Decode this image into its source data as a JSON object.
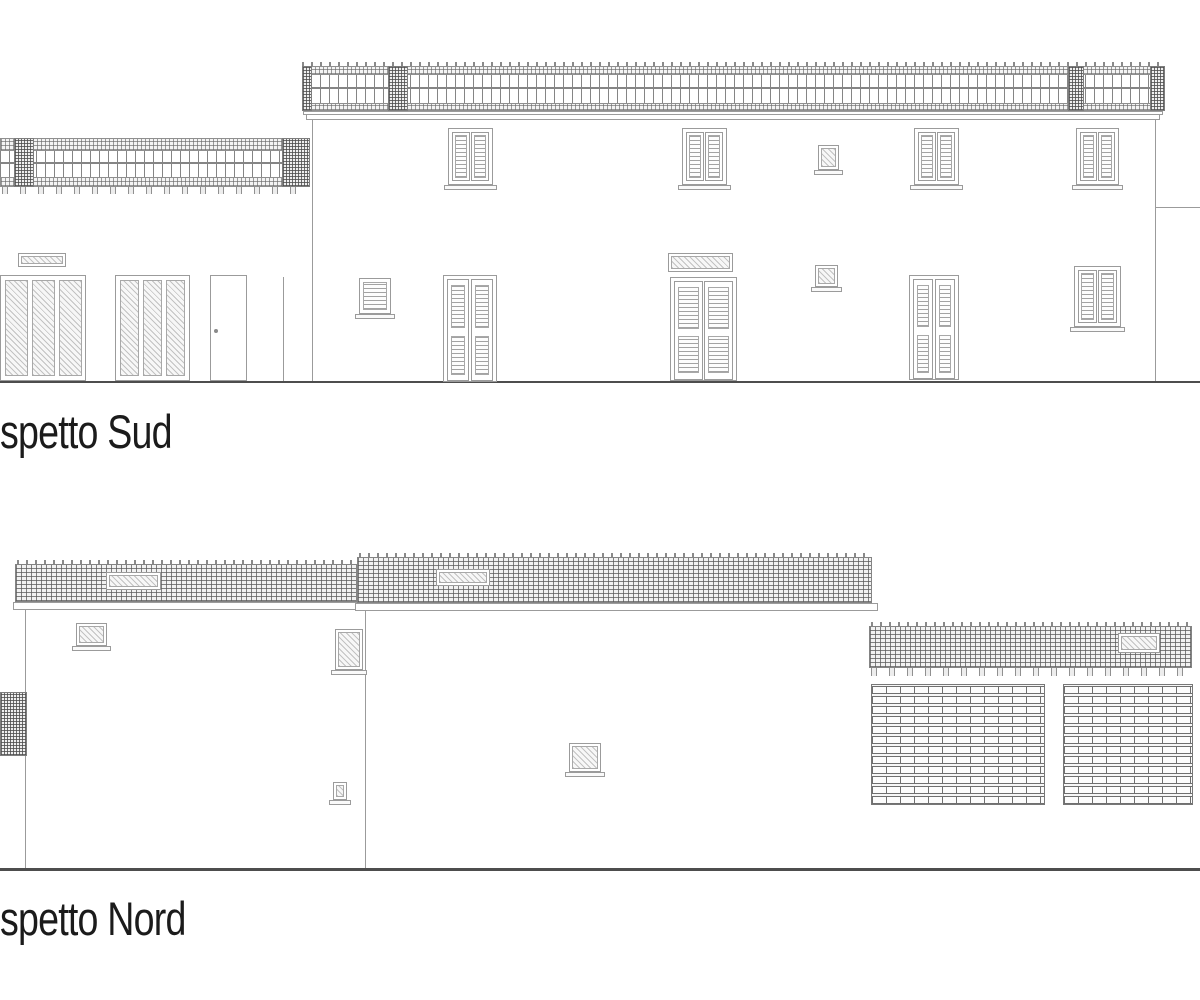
{
  "drawing": {
    "type": "architectural-elevation-drawing",
    "colors": {
      "line": "#9b9b9b",
      "dark": "#4d4d4d",
      "text": "#1b1b1b",
      "bg": "#ffffff"
    }
  },
  "elevations": [
    {
      "id": "sud",
      "label": "spetto Sud",
      "elements": [
        {
          "type": "hline",
          "name": "ground-line-sud",
          "cls": "dark",
          "rect": [
            0,
            381,
            1200,
            2
          ]
        },
        {
          "type": "band",
          "name": "wing-pergola-top-band",
          "rect": [
            0,
            138,
            310,
            13
          ]
        },
        {
          "type": "posts",
          "name": "wing-pergola-posts",
          "rect": [
            0,
            151,
            310,
            26
          ]
        },
        {
          "type": "midrail",
          "name": "wing-pergola-midrail",
          "rect": [
            0,
            162,
            310,
            2
          ]
        },
        {
          "type": "band",
          "name": "wing-pergola-bottom-band",
          "rect": [
            0,
            177,
            310,
            10
          ]
        },
        {
          "type": "feet",
          "name": "wing-pergola-feet",
          "rect": [
            2,
            187,
            306,
            7
          ]
        },
        {
          "type": "pillar",
          "name": "wing-pergola-pillar-left",
          "rect": [
            14,
            138,
            20,
            49
          ]
        },
        {
          "type": "pillar",
          "name": "wing-pergola-pillar-right",
          "rect": [
            282,
            138,
            28,
            49
          ]
        },
        {
          "type": "ticks",
          "name": "main-pergola-rafter-ticks",
          "rect": [
            302,
            62,
            863,
            5
          ]
        },
        {
          "type": "band",
          "name": "main-pergola-top-band",
          "rect": [
            302,
            66,
            863,
            9
          ]
        },
        {
          "type": "posts",
          "name": "main-pergola-posts",
          "rect": [
            302,
            75,
            863,
            28
          ]
        },
        {
          "type": "midrail",
          "name": "main-pergola-midrail",
          "rect": [
            302,
            87,
            863,
            2
          ]
        },
        {
          "type": "band",
          "name": "main-pergola-bottom-band",
          "rect": [
            302,
            103,
            863,
            8
          ]
        },
        {
          "type": "pillar",
          "name": "main-pergola-pillar-1",
          "rect": [
            302,
            66,
            10,
            45
          ]
        },
        {
          "type": "pillar",
          "name": "main-pergola-pillar-2",
          "rect": [
            388,
            66,
            20,
            45
          ]
        },
        {
          "type": "pillar",
          "name": "main-pergola-pillar-3",
          "rect": [
            1068,
            66,
            16,
            45
          ]
        },
        {
          "type": "pillar",
          "name": "main-pergola-pillar-4",
          "rect": [
            1150,
            66,
            15,
            45
          ]
        },
        {
          "type": "rect",
          "name": "cornice-upper",
          "cls": "outline",
          "rect": [
            303,
            111,
            860,
            4
          ]
        },
        {
          "type": "rect",
          "name": "cornice-lower",
          "cls": "outline",
          "rect": [
            306,
            114,
            854,
            6
          ]
        },
        {
          "type": "hline",
          "name": "main-wall-top-edge",
          "rect": [
            312,
            119,
            843,
            1
          ]
        },
        {
          "type": "vline",
          "name": "main-wall-left-edge",
          "rect": [
            312,
            119,
            1,
            262
          ]
        },
        {
          "type": "vline",
          "name": "main-wall-right-edge",
          "rect": [
            1155,
            119,
            1,
            262
          ]
        },
        {
          "type": "hline",
          "name": "adjacent-roofline-right",
          "rect": [
            1155,
            207,
            45,
            1
          ]
        },
        {
          "type": "vline",
          "name": "wing-wall-corner",
          "rect": [
            283,
            277,
            1,
            104
          ]
        },
        {
          "type": "winsh",
          "name": "upper-window-1",
          "rect": [
            448,
            128,
            45,
            57
          ],
          "sill": true
        },
        {
          "type": "winsh",
          "name": "upper-window-2",
          "rect": [
            682,
            128,
            45,
            57
          ],
          "sill": true
        },
        {
          "type": "winsh",
          "name": "upper-window-3",
          "rect": [
            914,
            128,
            45,
            57
          ],
          "sill": true
        },
        {
          "type": "winsh",
          "name": "upper-window-4",
          "rect": [
            1076,
            128,
            43,
            57
          ],
          "sill": true
        },
        {
          "type": "framedhatch",
          "name": "upper-small-window",
          "rect": [
            818,
            145,
            21,
            25
          ],
          "sill": true
        },
        {
          "type": "framedhatch",
          "name": "transom-window-left",
          "rect": [
            18,
            253,
            48,
            14
          ]
        },
        {
          "type": "glazed3",
          "name": "glazed-door-left-1",
          "rect": [
            0,
            275,
            86,
            106
          ]
        },
        {
          "type": "glazed3",
          "name": "glazed-door-left-2",
          "rect": [
            115,
            275,
            75,
            106
          ]
        },
        {
          "type": "plaindoor",
          "name": "service-door",
          "rect": [
            210,
            275,
            37,
            106
          ]
        },
        {
          "type": "louverwin",
          "name": "ground-louver-window",
          "rect": [
            359,
            278,
            32,
            36
          ],
          "sill": true
        },
        {
          "type": "doorlv",
          "name": "shuttered-door-1",
          "rect": [
            443,
            275,
            54,
            107
          ]
        },
        {
          "type": "framedhatch",
          "name": "transom-window-mid",
          "rect": [
            668,
            253,
            65,
            19
          ]
        },
        {
          "type": "doorlv",
          "name": "shuttered-door-2",
          "rect": [
            670,
            277,
            67,
            104
          ]
        },
        {
          "type": "framedhatch",
          "name": "ground-small-window",
          "rect": [
            815,
            265,
            23,
            22
          ],
          "sill": true
        },
        {
          "type": "doorlv",
          "name": "shuttered-door-3",
          "rect": [
            909,
            275,
            50,
            105
          ]
        },
        {
          "type": "winsh",
          "name": "ground-window-right",
          "rect": [
            1074,
            266,
            47,
            61
          ],
          "sill": true
        },
        {
          "type": "label",
          "name": "elevation-label-sud",
          "bind": "elevations.0.label",
          "rect": [
            0,
            408,
            300,
            50
          ]
        }
      ]
    },
    {
      "id": "nord",
      "label": "spetto Nord",
      "elements": [
        {
          "type": "hline",
          "name": "ground-line-nord",
          "cls": "dark",
          "rect": [
            0,
            868,
            1200,
            3
          ]
        },
        {
          "type": "ticks",
          "name": "roof-a-tile-ticks",
          "rect": [
            17,
            560,
            340,
            5
          ]
        },
        {
          "type": "rect",
          "name": "roof-a-tile-band",
          "cls": "roofgrid",
          "rect": [
            15,
            564,
            342,
            38
          ]
        },
        {
          "type": "rect",
          "name": "roof-a-fascia",
          "cls": "outline",
          "rect": [
            13,
            602,
            348,
            8
          ]
        },
        {
          "type": "framedhatch",
          "name": "roof-a-vent",
          "rect": [
            106,
            572,
            55,
            18
          ]
        },
        {
          "type": "ticks",
          "name": "roof-b-tile-ticks",
          "rect": [
            359,
            553,
            513,
            5
          ]
        },
        {
          "type": "rect",
          "name": "roof-b-tile-band",
          "cls": "roofgrid",
          "rect": [
            357,
            557,
            515,
            46
          ]
        },
        {
          "type": "rect",
          "name": "roof-b-fascia",
          "cls": "outline",
          "rect": [
            355,
            603,
            523,
            8
          ]
        },
        {
          "type": "framedhatch",
          "name": "roof-b-vent",
          "rect": [
            436,
            569,
            54,
            17
          ]
        },
        {
          "type": "vline",
          "name": "north-wall-left-edge",
          "rect": [
            25,
            610,
            1,
            258
          ]
        },
        {
          "type": "vline",
          "name": "north-wall-division",
          "rect": [
            365,
            610,
            1,
            258
          ]
        },
        {
          "type": "framedhatch",
          "name": "north-window-1",
          "rect": [
            76,
            623,
            31,
            23
          ],
          "sill": true
        },
        {
          "type": "framedhatch",
          "name": "north-window-2",
          "rect": [
            335,
            629,
            28,
            41
          ],
          "sill": true
        },
        {
          "type": "framedhatch",
          "name": "north-vent",
          "rect": [
            333,
            782,
            14,
            18
          ],
          "sill": true
        },
        {
          "type": "framedhatch",
          "name": "north-window-3",
          "rect": [
            569,
            743,
            32,
            29
          ],
          "sill": true
        },
        {
          "type": "rect",
          "name": "lattice-block-left",
          "cls": "dense",
          "rect": [
            0,
            692,
            27,
            64
          ]
        },
        {
          "type": "ticks",
          "name": "wing-roof-tile-ticks",
          "rect": [
            871,
            622,
            321,
            5
          ]
        },
        {
          "type": "rect",
          "name": "wing-roof-tile-band",
          "cls": "roofgrid",
          "rect": [
            869,
            626,
            323,
            42
          ]
        },
        {
          "type": "feet",
          "name": "wing-roof-feet",
          "rect": [
            871,
            668,
            321,
            8
          ]
        },
        {
          "type": "framedhatch",
          "name": "wing-roof-vent",
          "rect": [
            1118,
            633,
            42,
            20
          ]
        },
        {
          "type": "rect",
          "name": "brick-lattice-panel-1",
          "cls": "latticepanel",
          "rect": [
            871,
            684,
            174,
            121
          ]
        },
        {
          "type": "rect",
          "name": "brick-lattice-panel-2",
          "cls": "latticepanel",
          "rect": [
            1063,
            684,
            130,
            121
          ]
        },
        {
          "type": "label",
          "name": "elevation-label-nord",
          "bind": "elevations.1.label",
          "rect": [
            0,
            895,
            320,
            52
          ]
        }
      ]
    }
  ]
}
